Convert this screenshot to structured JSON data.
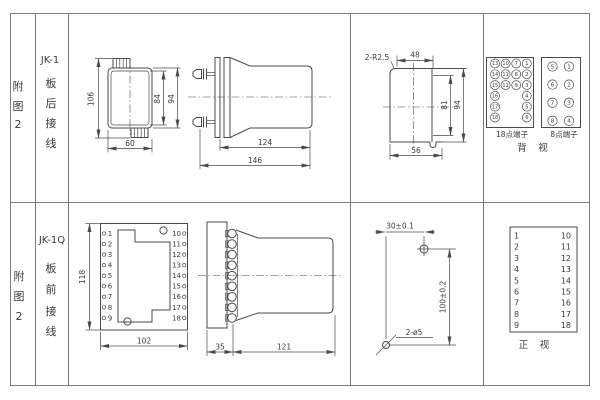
{
  "page": {
    "background": "#ffffff",
    "line_color": "#4a4a4a",
    "grid_color": "#7d7d7d"
  },
  "sidebar": {
    "top": {
      "fig": [
        "附",
        "图",
        "2"
      ],
      "model": "JK-1",
      "mount": [
        "板",
        "后",
        "接",
        "线"
      ]
    },
    "bottom": {
      "fig": [
        "附",
        "图",
        "2"
      ],
      "model": "JK-1Q",
      "mount": [
        "板",
        "前",
        "接",
        "线"
      ]
    }
  },
  "jk1_rear": {
    "d_left": "106",
    "d_inner": "84",
    "d_right": "94",
    "d_width": "60"
  },
  "jk1_side": {
    "d_body": "124",
    "d_total": "146"
  },
  "cutout": {
    "radius": "2-R2.5",
    "d_top": "48",
    "d_inner": "81",
    "d_outer": "94",
    "d_bottom": "56"
  },
  "rear_terms": {
    "t18": {
      "label": "18点端子",
      "col1": [
        "13",
        "14",
        "15",
        "16",
        "17",
        "18"
      ],
      "col2": [
        "10",
        "11",
        "12"
      ],
      "col3": [
        "7",
        "8",
        "9"
      ],
      "col4": [
        "1",
        "2",
        "3",
        "4",
        "5",
        "6"
      ]
    },
    "t8": {
      "label": "8点端子",
      "left": [
        "5",
        "6",
        "7",
        "8"
      ],
      "right": [
        "1",
        "2",
        "3",
        "4"
      ]
    },
    "view": "背　视"
  },
  "jk1q_front": {
    "left": [
      "1",
      "2",
      "3",
      "4",
      "5",
      "6",
      "7",
      "8",
      "9"
    ],
    "right": [
      "10",
      "11",
      "12",
      "13",
      "14",
      "15",
      "16",
      "17",
      "18"
    ],
    "d_height": "118",
    "d_width": "102"
  },
  "jk1q_side": {
    "d_plate": "35",
    "d_body": "121"
  },
  "drill": {
    "d_h": "30±0.1",
    "d_v": "100±0.2",
    "d_holes": "2-ø5"
  },
  "front_table": {
    "left": [
      "1",
      "2",
      "3",
      "4",
      "5",
      "6",
      "7",
      "8",
      "9"
    ],
    "right": [
      "10",
      "11",
      "12",
      "13",
      "14",
      "15",
      "16",
      "17",
      "18"
    ],
    "view": "正　视"
  }
}
